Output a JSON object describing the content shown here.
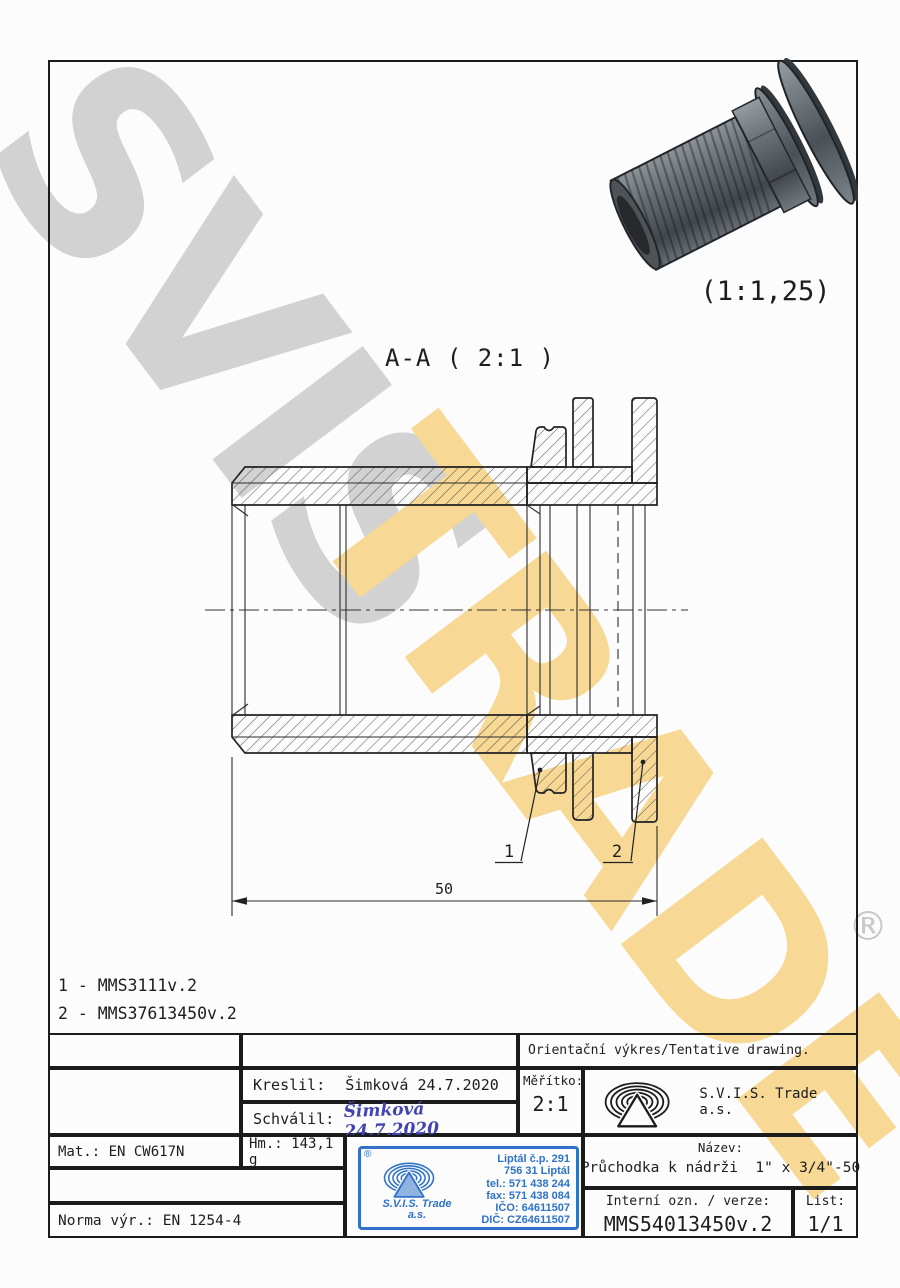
{
  "watermark": {
    "word1": "SVIS",
    "word2": "TRADE",
    "registered": "®",
    "colors": {
      "gray": "#d2d2d2",
      "yellow": "#f7d995"
    }
  },
  "preview": {
    "scale_label": "(1:1,25)"
  },
  "drawing": {
    "view_title": "A-A ( 2:1 )",
    "dimension_length": "50",
    "callout_1": "1",
    "callout_2": "2"
  },
  "parts_list": {
    "line1": "1 - MMS3111v.2",
    "line2": "2 - MMS37613450v.2"
  },
  "title_block": {
    "tentative": "Orientační výkres/Tentative drawing.",
    "kreslil_label": "Kreslil:",
    "kreslil_value": "Šimková 24.7.2020",
    "schvalil_label": "Schválil:",
    "schvalil_value": "Šimková 24.7.2020",
    "meritko_label": "Měřítko:",
    "meritko_value": "2:1",
    "company": "S.V.I.S. Trade a.s.",
    "mat": "Mat.: EN CW617N",
    "hm": "Hm.: 143,1 g",
    "norma": "Norma výr.: EN 1254-4",
    "nazev_label": "Název:",
    "nazev_value": "Průchodka k nádrži  1\" x 3/4\"-50",
    "interni_label": "Interní ozn. / verze:",
    "interni_value": "MMS54013450v.2",
    "list_label": "List:",
    "list_value": "1/1"
  },
  "stamp": {
    "registered": "®",
    "company_line1": "S.V.I.S. Trade",
    "company_line2": "a.s.",
    "address": [
      "Liptál č.p. 291",
      "756 31 Liptál",
      "tel.: 571 438 244",
      "fax: 571 438 084",
      "IČO: 64611507",
      "DIČ: CZ64611507"
    ],
    "blue": "#2f72c8"
  }
}
